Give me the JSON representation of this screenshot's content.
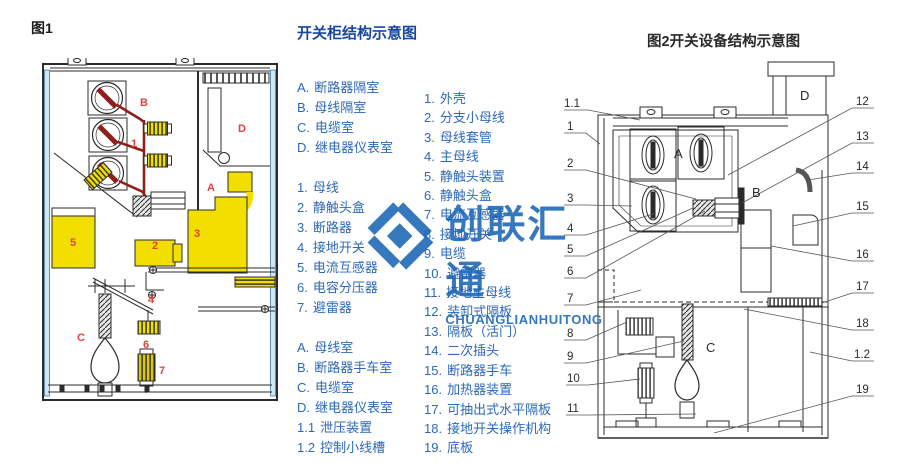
{
  "figure1": {
    "caption": "图1",
    "labels": {
      "B": "B",
      "n1": "1",
      "D": "D",
      "A": "A",
      "n3": "3",
      "n2": "2",
      "n5": "5",
      "n4": "4",
      "C": "C",
      "n6": "6",
      "n7": "7"
    }
  },
  "legend": {
    "title": "开关柜结构示意图",
    "groups": [
      {
        "name": "compartments-top",
        "items": [
          {
            "key": "A.",
            "label": "断路器隔室"
          },
          {
            "key": "B.",
            "label": "母线隔室"
          },
          {
            "key": "C.",
            "label": "电缆室"
          },
          {
            "key": "D.",
            "label": "继电器仪表室"
          }
        ]
      },
      {
        "name": "parts-fig1",
        "items": [
          {
            "key": "1.",
            "label": "母线"
          },
          {
            "key": "2.",
            "label": "静触头盒"
          },
          {
            "key": "3.",
            "label": "断路器"
          },
          {
            "key": "4.",
            "label": "接地开关"
          },
          {
            "key": "5.",
            "label": "电流互感器"
          },
          {
            "key": "6.",
            "label": "电容分压器"
          },
          {
            "key": "7.",
            "label": "避雷器"
          }
        ]
      },
      {
        "name": "compartments-fig2",
        "items": [
          {
            "key": "A.",
            "label": "母线室"
          },
          {
            "key": "B.",
            "label": "断路器手车室"
          },
          {
            "key": "C.",
            "label": "电缆室"
          },
          {
            "key": "D.",
            "label": "继电器仪表室"
          },
          {
            "key": "1.1",
            "label": "泄压装置"
          },
          {
            "key": "1.2",
            "label": "控制小线槽"
          }
        ]
      },
      {
        "name": "parts-fig2",
        "items": [
          {
            "key": "1.",
            "label": "外壳"
          },
          {
            "key": "2.",
            "label": "分支小母线"
          },
          {
            "key": "3.",
            "label": "母线套管"
          },
          {
            "key": "4.",
            "label": "主母线"
          },
          {
            "key": "5.",
            "label": "静触头装置"
          },
          {
            "key": "6.",
            "label": "静触头盒"
          },
          {
            "key": "7.",
            "label": "电流互感器"
          },
          {
            "key": "8.",
            "label": "接地开关"
          },
          {
            "key": "9.",
            "label": "电缆"
          },
          {
            "key": "10.",
            "label": "避雷器"
          },
          {
            "key": "11.",
            "label": "接地主母线"
          },
          {
            "key": "12.",
            "label": "装卸式隔板"
          },
          {
            "key": "13.",
            "label": "隔板（活门）"
          },
          {
            "key": "14.",
            "label": "二次插头"
          },
          {
            "key": "15.",
            "label": "断路器手车"
          },
          {
            "key": "16.",
            "label": "加热器装置"
          },
          {
            "key": "17.",
            "label": "可抽出式水平隔板"
          },
          {
            "key": "18.",
            "label": "接地开关操作机构"
          },
          {
            "key": "19.",
            "label": "底板"
          }
        ]
      }
    ]
  },
  "figure2": {
    "caption": "图2开关设备结构示意图",
    "letters": {
      "A": "A",
      "B": "B",
      "C": "C",
      "D": "D"
    },
    "callouts_left": [
      "1.1",
      "1",
      "2",
      "3",
      "4",
      "5",
      "6",
      "7",
      "8",
      "9",
      "10",
      "11"
    ],
    "callouts_right": [
      "12",
      "13",
      "14",
      "15",
      "16",
      "17",
      "18",
      "1.2",
      "19"
    ]
  },
  "watermark": {
    "cn": "创联汇通",
    "en": "CHUANGLIANHUITONG"
  },
  "colors": {
    "legend_text": "#2d69b6",
    "title_blue": "#17489e",
    "label_red": "#e0433a",
    "component_yellow": "#f2df00",
    "bus_dark_red": "#8e1f1a",
    "panel_light_blue": "#cde7f6",
    "watermark_blue": "#1b66b6",
    "line": "#2b2b2b"
  }
}
